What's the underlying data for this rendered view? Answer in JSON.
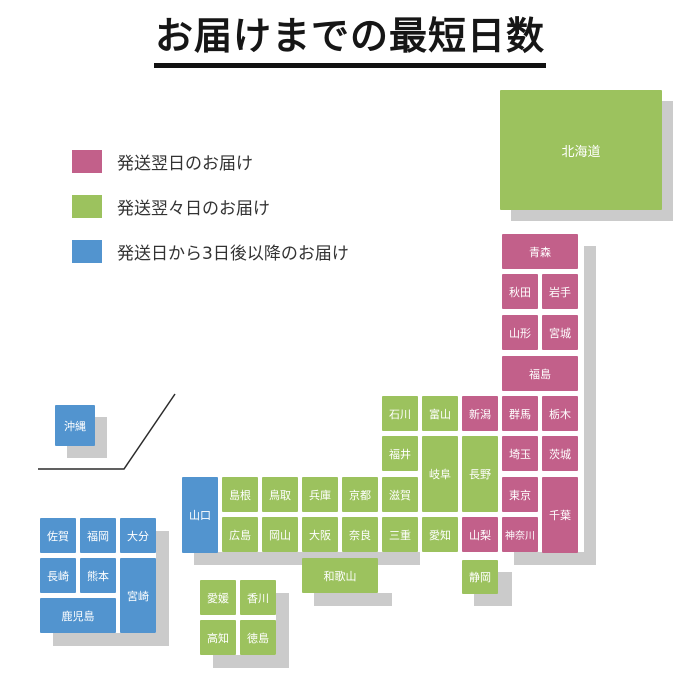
{
  "title": {
    "text": "お届けまでの最短日数"
  },
  "legend": {
    "items": [
      {
        "key": "next_day",
        "label": "発送翌日のお届け",
        "color": "#c2608a"
      },
      {
        "key": "two_days",
        "label": "発送翌々日のお届け",
        "color": "#9cc25e"
      },
      {
        "key": "three_plus_days",
        "label": "発送日から3日後以降のお届け",
        "color": "#5294cf"
      }
    ]
  },
  "colors": {
    "next_day": "#c2608a",
    "two_days": "#9cc25e",
    "three_plus_days": "#5294cf",
    "shadow": "#cbcbcb"
  },
  "map": {
    "cells": [
      {
        "key": "hokkaido",
        "name": "北海道",
        "cat": "two_days",
        "x": 500,
        "y": 90,
        "w": 162,
        "h": 120
      },
      {
        "key": "aomori",
        "name": "青森",
        "cat": "next_day",
        "x": 502,
        "y": 234,
        "w": 76,
        "h": 35
      },
      {
        "key": "akita",
        "name": "秋田",
        "cat": "next_day",
        "x": 502,
        "y": 274,
        "w": 36,
        "h": 35
      },
      {
        "key": "iwate",
        "name": "岩手",
        "cat": "next_day",
        "x": 542,
        "y": 274,
        "w": 36,
        "h": 35
      },
      {
        "key": "yamagata",
        "name": "山形",
        "cat": "next_day",
        "x": 502,
        "y": 315,
        "w": 36,
        "h": 35
      },
      {
        "key": "miyagi",
        "name": "宮城",
        "cat": "next_day",
        "x": 542,
        "y": 315,
        "w": 36,
        "h": 35
      },
      {
        "key": "fukushima",
        "name": "福島",
        "cat": "next_day",
        "x": 502,
        "y": 356,
        "w": 76,
        "h": 35
      },
      {
        "key": "ishikawa",
        "name": "石川",
        "cat": "two_days",
        "x": 382,
        "y": 396,
        "w": 36,
        "h": 35
      },
      {
        "key": "toyama",
        "name": "富山",
        "cat": "two_days",
        "x": 422,
        "y": 396,
        "w": 36,
        "h": 35
      },
      {
        "key": "niigata",
        "name": "新潟",
        "cat": "next_day",
        "x": 462,
        "y": 396,
        "w": 36,
        "h": 35
      },
      {
        "key": "gunma",
        "name": "群馬",
        "cat": "next_day",
        "x": 502,
        "y": 396,
        "w": 36,
        "h": 35
      },
      {
        "key": "tochigi",
        "name": "栃木",
        "cat": "next_day",
        "x": 542,
        "y": 396,
        "w": 36,
        "h": 35
      },
      {
        "key": "fukui",
        "name": "福井",
        "cat": "two_days",
        "x": 382,
        "y": 436,
        "w": 36,
        "h": 35
      },
      {
        "key": "gifu",
        "name": "岐阜",
        "cat": "two_days",
        "x": 422,
        "y": 436,
        "w": 36,
        "h": 76
      },
      {
        "key": "nagano",
        "name": "長野",
        "cat": "two_days",
        "x": 462,
        "y": 436,
        "w": 36,
        "h": 76
      },
      {
        "key": "saitama",
        "name": "埼玉",
        "cat": "next_day",
        "x": 502,
        "y": 436,
        "w": 36,
        "h": 35
      },
      {
        "key": "ibaraki",
        "name": "茨城",
        "cat": "next_day",
        "x": 542,
        "y": 436,
        "w": 36,
        "h": 35
      },
      {
        "key": "shimane",
        "name": "島根",
        "cat": "two_days",
        "x": 222,
        "y": 477,
        "w": 36,
        "h": 35
      },
      {
        "key": "tottori",
        "name": "鳥取",
        "cat": "two_days",
        "x": 262,
        "y": 477,
        "w": 36,
        "h": 35
      },
      {
        "key": "hyogo",
        "name": "兵庫",
        "cat": "two_days",
        "x": 302,
        "y": 477,
        "w": 36,
        "h": 35
      },
      {
        "key": "kyoto",
        "name": "京都",
        "cat": "two_days",
        "x": 342,
        "y": 477,
        "w": 36,
        "h": 35
      },
      {
        "key": "shiga",
        "name": "滋賀",
        "cat": "two_days",
        "x": 382,
        "y": 477,
        "w": 36,
        "h": 35
      },
      {
        "key": "tokyo",
        "name": "東京",
        "cat": "next_day",
        "x": 502,
        "y": 477,
        "w": 36,
        "h": 35
      },
      {
        "key": "chiba",
        "name": "千葉",
        "cat": "next_day",
        "x": 542,
        "y": 477,
        "w": 36,
        "h": 76
      },
      {
        "key": "yamaguchi",
        "name": "山口",
        "cat": "three_plus_days",
        "x": 182,
        "y": 477,
        "w": 36,
        "h": 76
      },
      {
        "key": "hiroshima",
        "name": "広島",
        "cat": "two_days",
        "x": 222,
        "y": 517,
        "w": 36,
        "h": 35
      },
      {
        "key": "okayama",
        "name": "岡山",
        "cat": "two_days",
        "x": 262,
        "y": 517,
        "w": 36,
        "h": 35
      },
      {
        "key": "osaka",
        "name": "大阪",
        "cat": "two_days",
        "x": 302,
        "y": 517,
        "w": 36,
        "h": 35
      },
      {
        "key": "nara",
        "name": "奈良",
        "cat": "two_days",
        "x": 342,
        "y": 517,
        "w": 36,
        "h": 35
      },
      {
        "key": "mie",
        "name": "三重",
        "cat": "two_days",
        "x": 382,
        "y": 517,
        "w": 36,
        "h": 35
      },
      {
        "key": "aichi",
        "name": "愛知",
        "cat": "two_days",
        "x": 422,
        "y": 517,
        "w": 36,
        "h": 35
      },
      {
        "key": "yamanashi",
        "name": "山梨",
        "cat": "next_day",
        "x": 462,
        "y": 517,
        "w": 36,
        "h": 35
      },
      {
        "key": "kanagawa",
        "name": "神奈川",
        "cat": "next_day",
        "x": 502,
        "y": 517,
        "w": 36,
        "h": 35
      },
      {
        "key": "wakayama",
        "name": "和歌山",
        "cat": "two_days",
        "x": 302,
        "y": 558,
        "w": 76,
        "h": 35
      },
      {
        "key": "shizuoka",
        "name": "静岡",
        "cat": "two_days",
        "x": 462,
        "y": 560,
        "w": 36,
        "h": 34
      },
      {
        "key": "ehime",
        "name": "愛媛",
        "cat": "two_days",
        "x": 200,
        "y": 580,
        "w": 36,
        "h": 35
      },
      {
        "key": "kagawa",
        "name": "香川",
        "cat": "two_days",
        "x": 240,
        "y": 580,
        "w": 36,
        "h": 35
      },
      {
        "key": "kochi",
        "name": "高知",
        "cat": "two_days",
        "x": 200,
        "y": 620,
        "w": 36,
        "h": 35
      },
      {
        "key": "tokushima",
        "name": "徳島",
        "cat": "two_days",
        "x": 240,
        "y": 620,
        "w": 36,
        "h": 35
      },
      {
        "key": "saga",
        "name": "佐賀",
        "cat": "three_plus_days",
        "x": 40,
        "y": 518,
        "w": 36,
        "h": 35
      },
      {
        "key": "fukuoka",
        "name": "福岡",
        "cat": "three_plus_days",
        "x": 80,
        "y": 518,
        "w": 36,
        "h": 35
      },
      {
        "key": "oita",
        "name": "大分",
        "cat": "three_plus_days",
        "x": 120,
        "y": 518,
        "w": 36,
        "h": 35
      },
      {
        "key": "nagasaki",
        "name": "長崎",
        "cat": "three_plus_days",
        "x": 40,
        "y": 558,
        "w": 36,
        "h": 35
      },
      {
        "key": "kumamoto",
        "name": "熊本",
        "cat": "three_plus_days",
        "x": 80,
        "y": 558,
        "w": 36,
        "h": 35
      },
      {
        "key": "miyazaki",
        "name": "宮崎",
        "cat": "three_plus_days",
        "x": 120,
        "y": 558,
        "w": 36,
        "h": 75
      },
      {
        "key": "kagoshima",
        "name": "鹿児島",
        "cat": "three_plus_days",
        "x": 40,
        "y": 598,
        "w": 76,
        "h": 35
      },
      {
        "key": "okinawa",
        "name": "沖縄",
        "cat": "three_plus_days",
        "x": 55,
        "y": 405,
        "w": 40,
        "h": 41
      }
    ],
    "shadow_rects": [
      {
        "x": 511,
        "y": 101,
        "w": 162,
        "h": 120
      },
      {
        "x": 584,
        "y": 246,
        "w": 12,
        "h": 319
      },
      {
        "x": 514,
        "y": 552,
        "w": 82,
        "h": 13
      },
      {
        "x": 194,
        "y": 552,
        "w": 226,
        "h": 13
      },
      {
        "x": 314,
        "y": 593,
        "w": 78,
        "h": 13
      },
      {
        "x": 474,
        "y": 572,
        "w": 38,
        "h": 34
      },
      {
        "x": 53,
        "y": 531,
        "w": 116,
        "h": 115
      },
      {
        "x": 213,
        "y": 593,
        "w": 76,
        "h": 75
      },
      {
        "x": 67,
        "y": 417,
        "w": 40,
        "h": 41
      }
    ],
    "backing_rects": [
      {
        "x": 40,
        "y": 518,
        "w": 116,
        "h": 115
      },
      {
        "x": 200,
        "y": 580,
        "w": 76,
        "h": 75
      }
    ],
    "divider_points": "38,469 124,469 175,394"
  }
}
